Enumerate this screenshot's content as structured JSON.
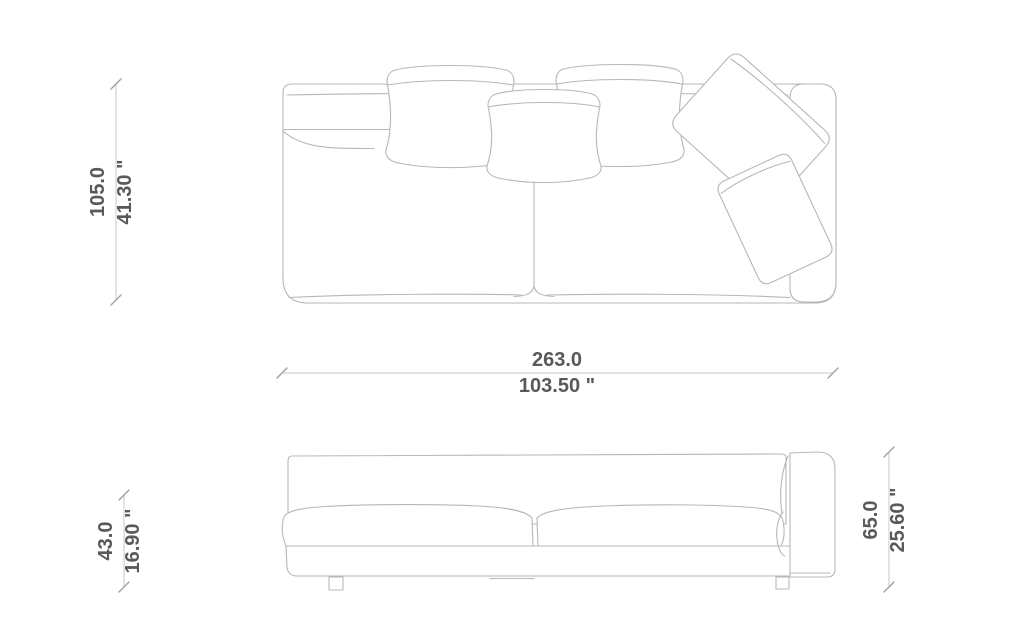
{
  "colors": {
    "background": "#ffffff",
    "drawing_line": "#b7b7b7",
    "dimension_line": "#c9c9c9",
    "tick": "#a0a0a0",
    "text": "#58595b"
  },
  "dimensions": {
    "depth": {
      "cm": "105.0",
      "inches": "41.30 \""
    },
    "width": {
      "cm": "263.0",
      "inches": "103.50 \""
    },
    "seat_height": {
      "cm": "43.0",
      "inches": "16.90 \""
    },
    "total_height": {
      "cm": "65.0",
      "inches": "25.60 \""
    }
  }
}
